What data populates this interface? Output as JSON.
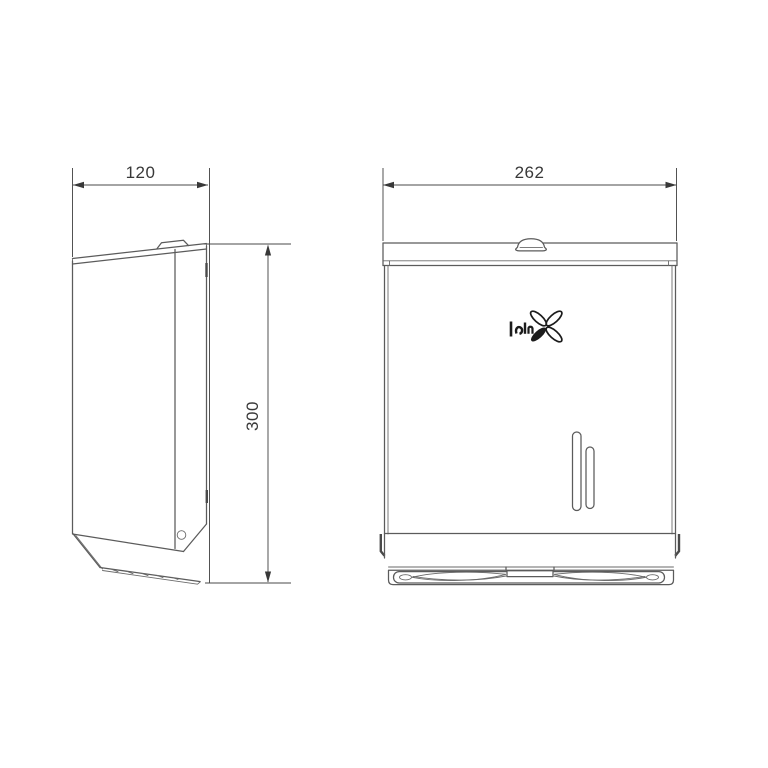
{
  "page": {
    "background": "#ffffff",
    "description": "Two-view engineering line drawing of a wall-mounted folded paper towel dispenser"
  },
  "drawing": {
    "views": {
      "side": {
        "name": "side profile view"
      },
      "front": {
        "name": "front elevation view"
      }
    },
    "labels": {
      "side_width": "120",
      "side_height": "300",
      "front_width": "262"
    },
    "logo": {
      "icon": "pinwheel-x-logo"
    }
  },
  "colors": {
    "background": "#ffffff",
    "object_line": "#5b5b5b",
    "dimension_line": "#4a4a4a",
    "dimension_text": "#383838",
    "logo": "#1c1c1c"
  }
}
